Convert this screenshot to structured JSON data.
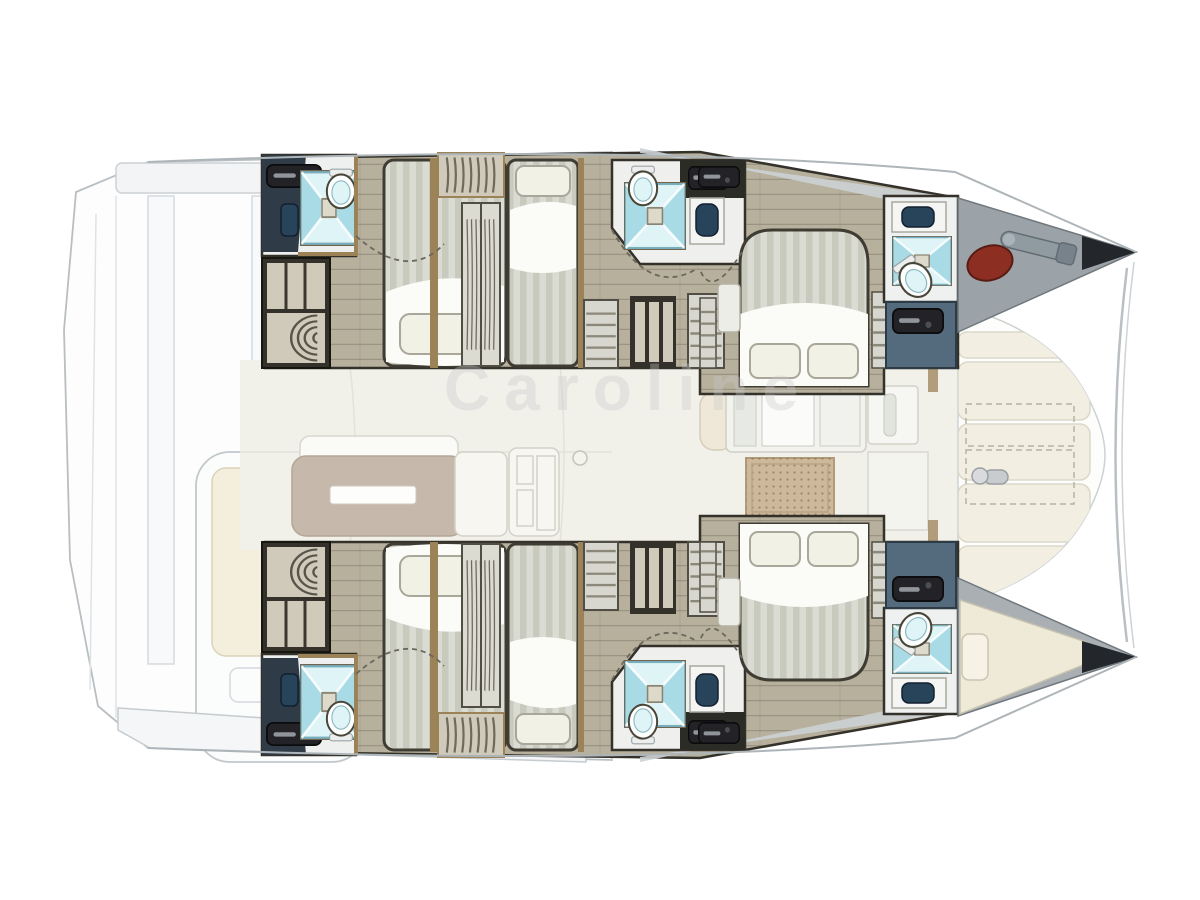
{
  "watermark": {
    "text": "Caroline"
  },
  "colors": {
    "floor": "#b7b09d",
    "wall-dark": "#33312a",
    "wall-slate": "#2f3b46",
    "wood": "#9b8257",
    "mattress-light": "#dadbd2",
    "mattress-dark": "#c9cabe",
    "sheet": "#fbfbf7",
    "pillow": "#f2f1e6",
    "shower-light": "#dff4f6",
    "shower-deep": "#a8dbe6",
    "sink-navy": "#27445a",
    "door-blue": "#536b7c",
    "table-taupe": "#c6b9ab",
    "rug-tan": "#cdb89c",
    "sunpad": "#f2efe2",
    "forepeak-gray": "#9ba3a8",
    "bow-dark": "#23272b",
    "fender-red": "#8c2f22",
    "deck-line": "#b8bec2",
    "saloon-floor": "#f1f0e9",
    "watermark-gray": "#c9c9c9"
  }
}
